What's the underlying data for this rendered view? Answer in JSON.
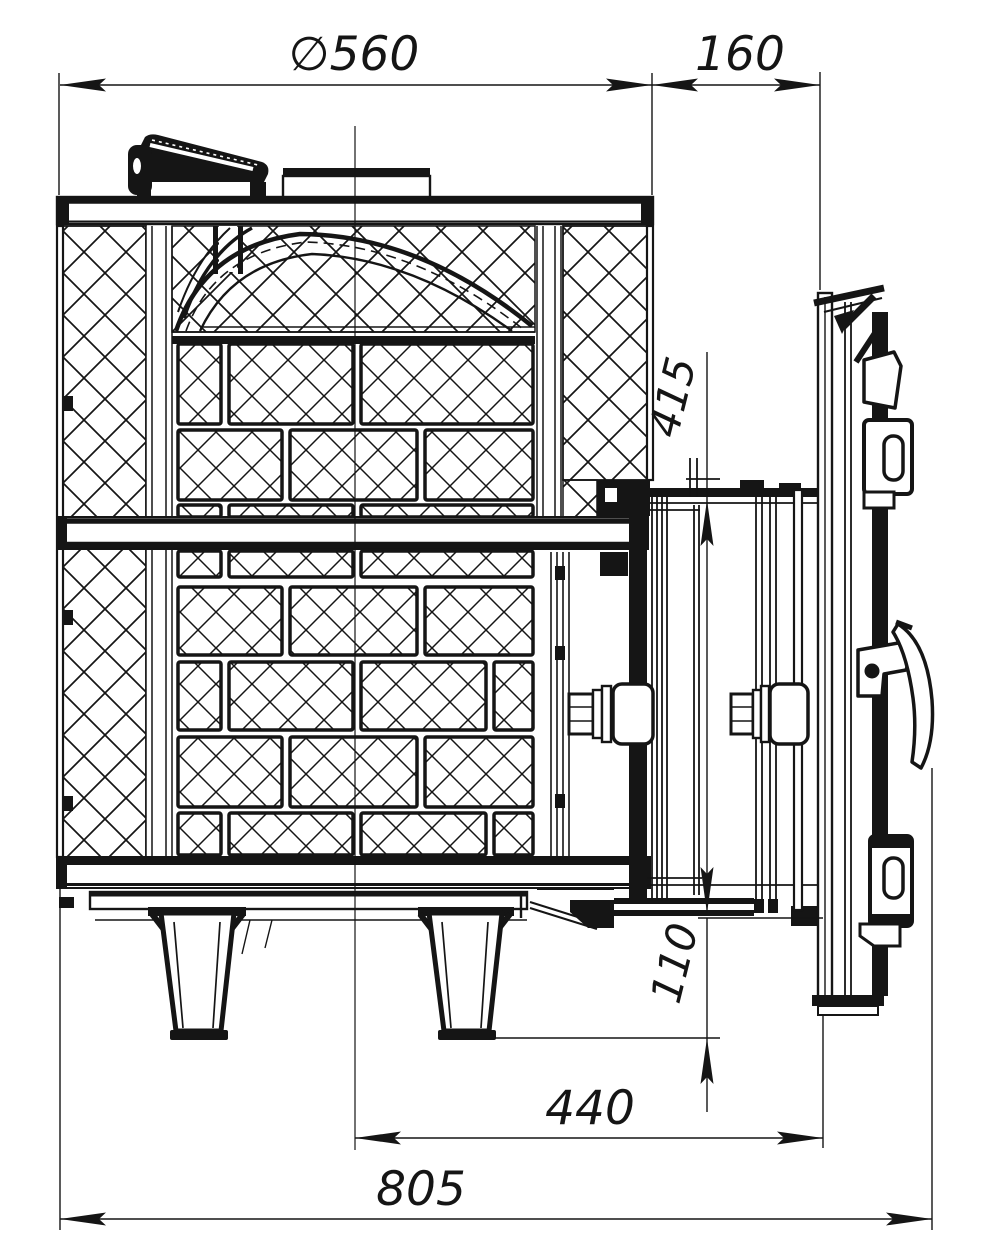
{
  "drawing": {
    "colors": {
      "ink": "#151515",
      "paper": "#ffffff"
    },
    "dimension_labels": {
      "top_diameter": "∅560",
      "door_offset": "160",
      "opening_height": "415",
      "bottom_clearance": "110",
      "center_to_door": "440",
      "overall_depth": "805"
    }
  }
}
